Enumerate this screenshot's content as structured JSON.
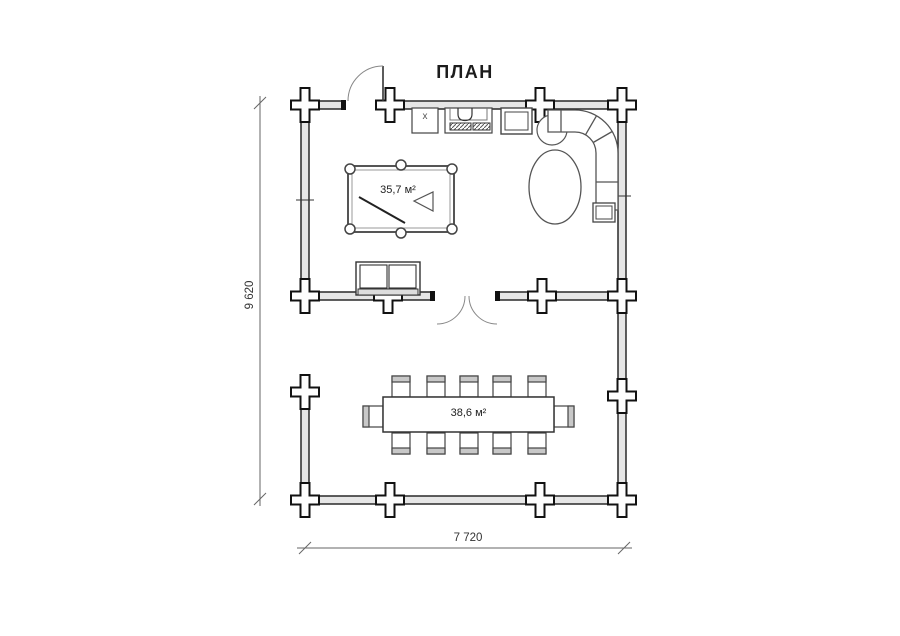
{
  "title": "ПЛАН",
  "labels": {
    "upper_room_area": "35,7 м²",
    "lower_room_area": "38,6 м²",
    "kitchen_sink": "x"
  },
  "dimensions": {
    "height": "9 620",
    "width": "7 720"
  },
  "furniture": [
    "billiard-table",
    "cue-stick",
    "rack-triangle",
    "two-seat-sofa",
    "kitchen-cabinet",
    "sink-unit",
    "stove-burners",
    "fridge",
    "corner-sofa",
    "round-chair",
    "oval-table",
    "side-table",
    "dining-table",
    "dining-chairs-x12"
  ],
  "colors": {
    "background": "#ffffff",
    "wall_outline": "#1b1b1b",
    "wall_fill": "#e6e6e6",
    "furniture_line": "#555555",
    "dimension_line": "#666666",
    "text": "#222222"
  }
}
